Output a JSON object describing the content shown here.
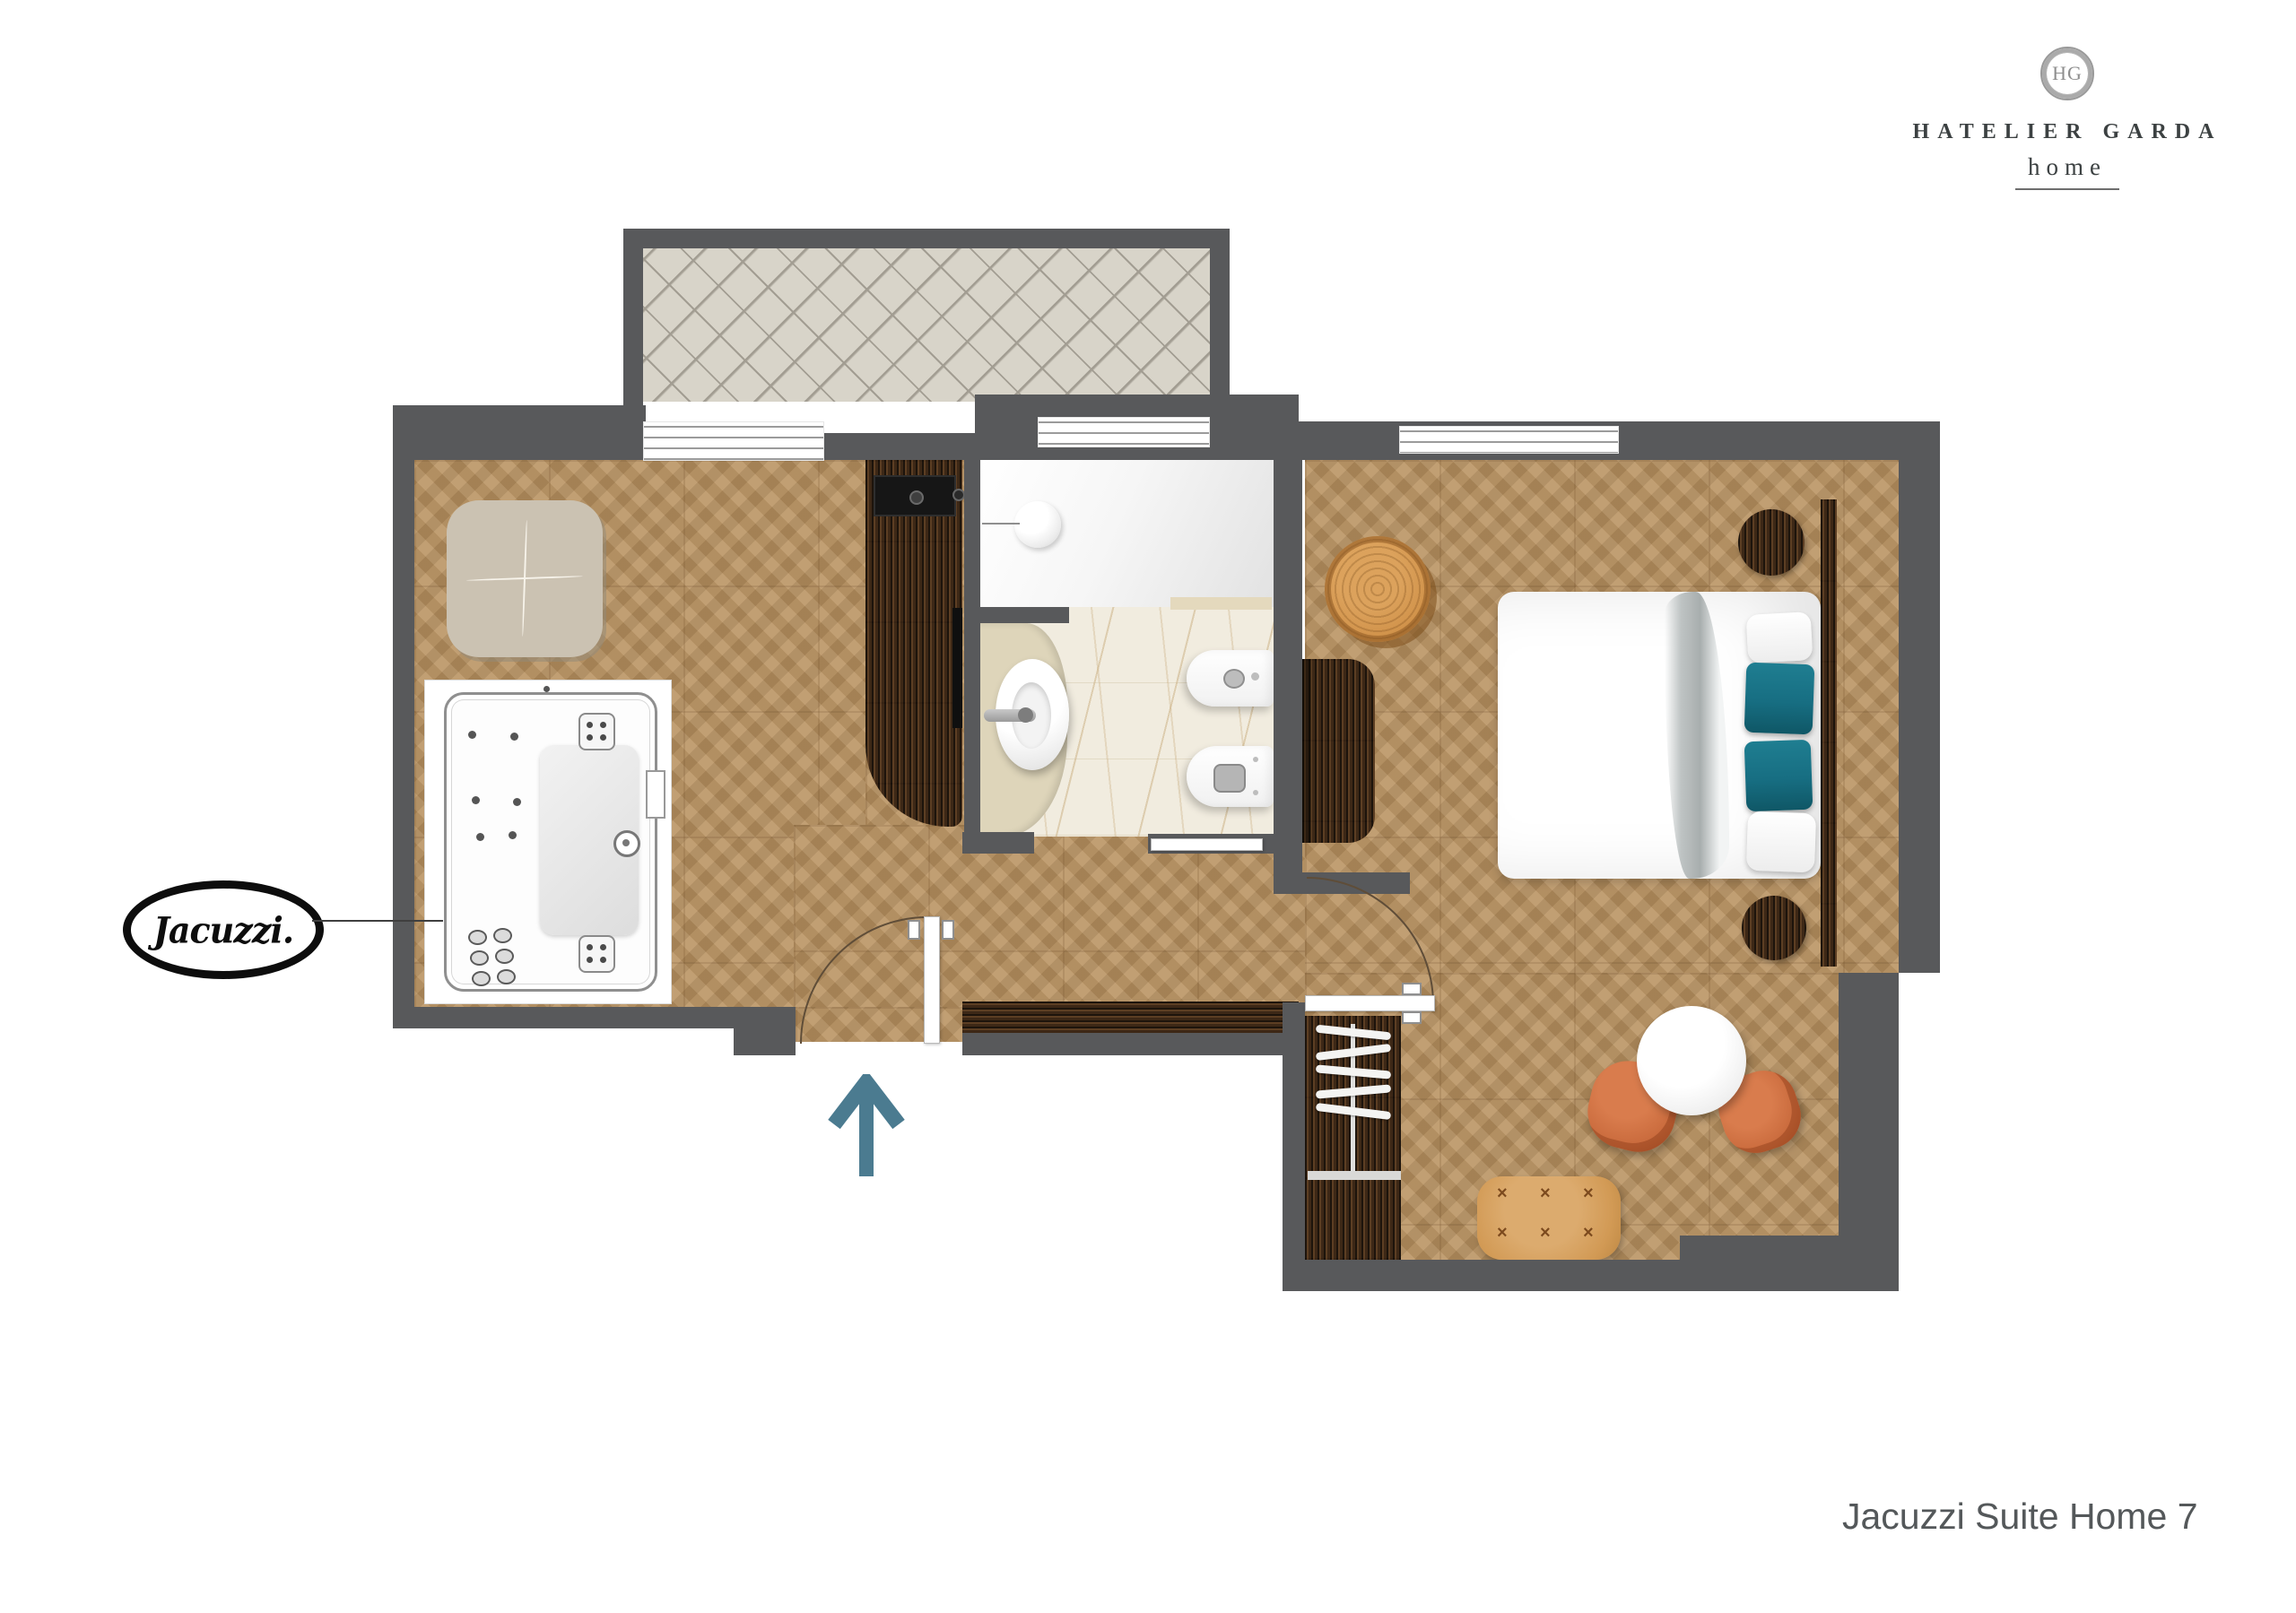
{
  "brand": {
    "initials": "HG",
    "name": "HATELIER GARDA",
    "sub": "home"
  },
  "badge": {
    "label": "Jacuzzi."
  },
  "caption": "Jacuzzi Suite Home 7",
  "palette": {
    "wall": "#58595b",
    "wood": "#b7905f",
    "walnut": "#3a2817",
    "tile": "#d8d4c9",
    "tilegrid": "#a29d92",
    "marble": "#f1ecdf",
    "counter": "#ded5ba",
    "ottoman": "#cbc2b2",
    "tan": "#d29a55",
    "terracotta": "#c96a3c",
    "teal": "#176e82",
    "arrow": "#4b7b90",
    "ink": "#3c4142",
    "caption": "#54585a"
  }
}
